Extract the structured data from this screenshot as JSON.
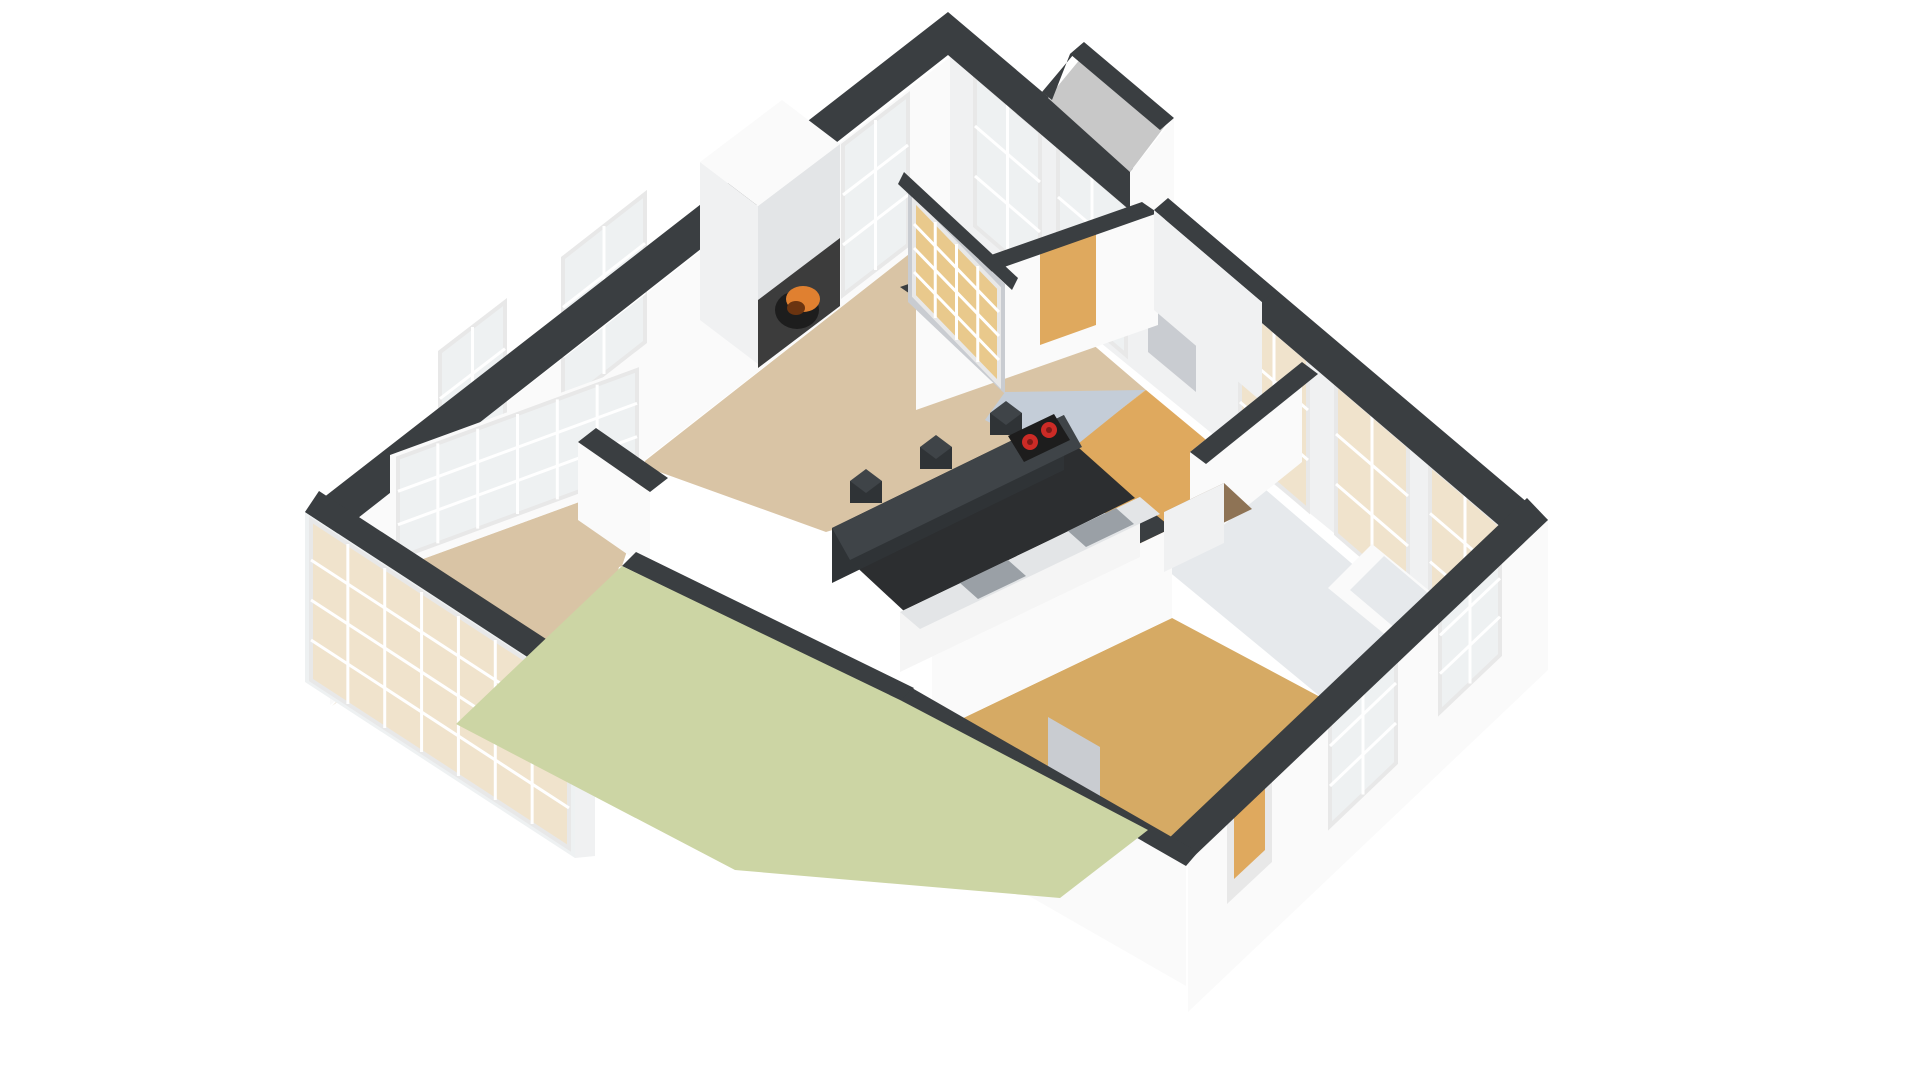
{
  "scene": {
    "kind": "3d-floorplan-render",
    "view": "isometric-birdseye",
    "background": "#ffffff",
    "rooms": [
      {
        "id": "living-room",
        "floor": "floor_living",
        "features": [
          "fireplace",
          "tall-windows",
          "french-doors"
        ]
      },
      {
        "id": "kitchen",
        "floor": "floor_kitchen",
        "features": [
          "island-counter",
          "bar-stools",
          "cooktop",
          "counter-run",
          "glass-block-wall"
        ]
      },
      {
        "id": "ne-room",
        "floor": "floor_orange",
        "features": [
          "windows",
          "entry-porch"
        ]
      },
      {
        "id": "hallway",
        "floor": "floor_orange",
        "features": [
          "doorways"
        ]
      },
      {
        "id": "bathroom",
        "floor": "floor_bath",
        "features": [
          "bathtub",
          "window"
        ]
      },
      {
        "id": "bedroom",
        "floor": "floor_bedroom",
        "features": [
          "wardrobe-nook",
          "terrace-door",
          "exterior-door",
          "windows"
        ]
      },
      {
        "id": "conservatory",
        "floor": "floor_living",
        "features": [
          "glass-walls"
        ]
      },
      {
        "id": "terrace",
        "floor": "terrace",
        "features": []
      }
    ],
    "furniture": [
      "fireplace-stove",
      "kitchen-island",
      "bar-stool",
      "bar-stool",
      "bar-stool",
      "cooktop-two-burners",
      "bathtub",
      "wardrobe"
    ],
    "window_count": 14,
    "door_count": 5
  },
  "colors": {
    "background": "#ffffff",
    "wall_top": "#3a3e41",
    "wall_white": "#fafafa",
    "wall_light": "#f0f1f2",
    "wall_shadow": "#e3e5e7",
    "wall_gray": "#c9ccd1",
    "wall_midgray": "#b7bbc1",
    "floor_living": "#d9c4a5",
    "floor_kitchen": "#c4cdd8",
    "floor_orange": "#dfa95e",
    "floor_bedroom": "#d6aa64",
    "floor_bath": "#e6e9ec",
    "floor_wood": "#8e7355",
    "terrace": "#ccd5a4",
    "porch": "#c8c8c8",
    "glass": "#eef1f2",
    "glass_tan": "#f0e3cc",
    "glass_block": "#e9c98c",
    "mullion": "#ffffff",
    "frame": "#e8e8e8",
    "island": "#3f4448",
    "island_side": "#2f3336",
    "aisle": "#2c2e30",
    "counter": "#f5f5f5",
    "counter_gray": "#9aa0a6",
    "burner_red": "#cc2b26",
    "burner_dark": "#7e1b18",
    "fire": "#e08030",
    "fire_dark": "#6b3410",
    "stove": "#1d1d1d",
    "grill": "#3c3c3c"
  }
}
